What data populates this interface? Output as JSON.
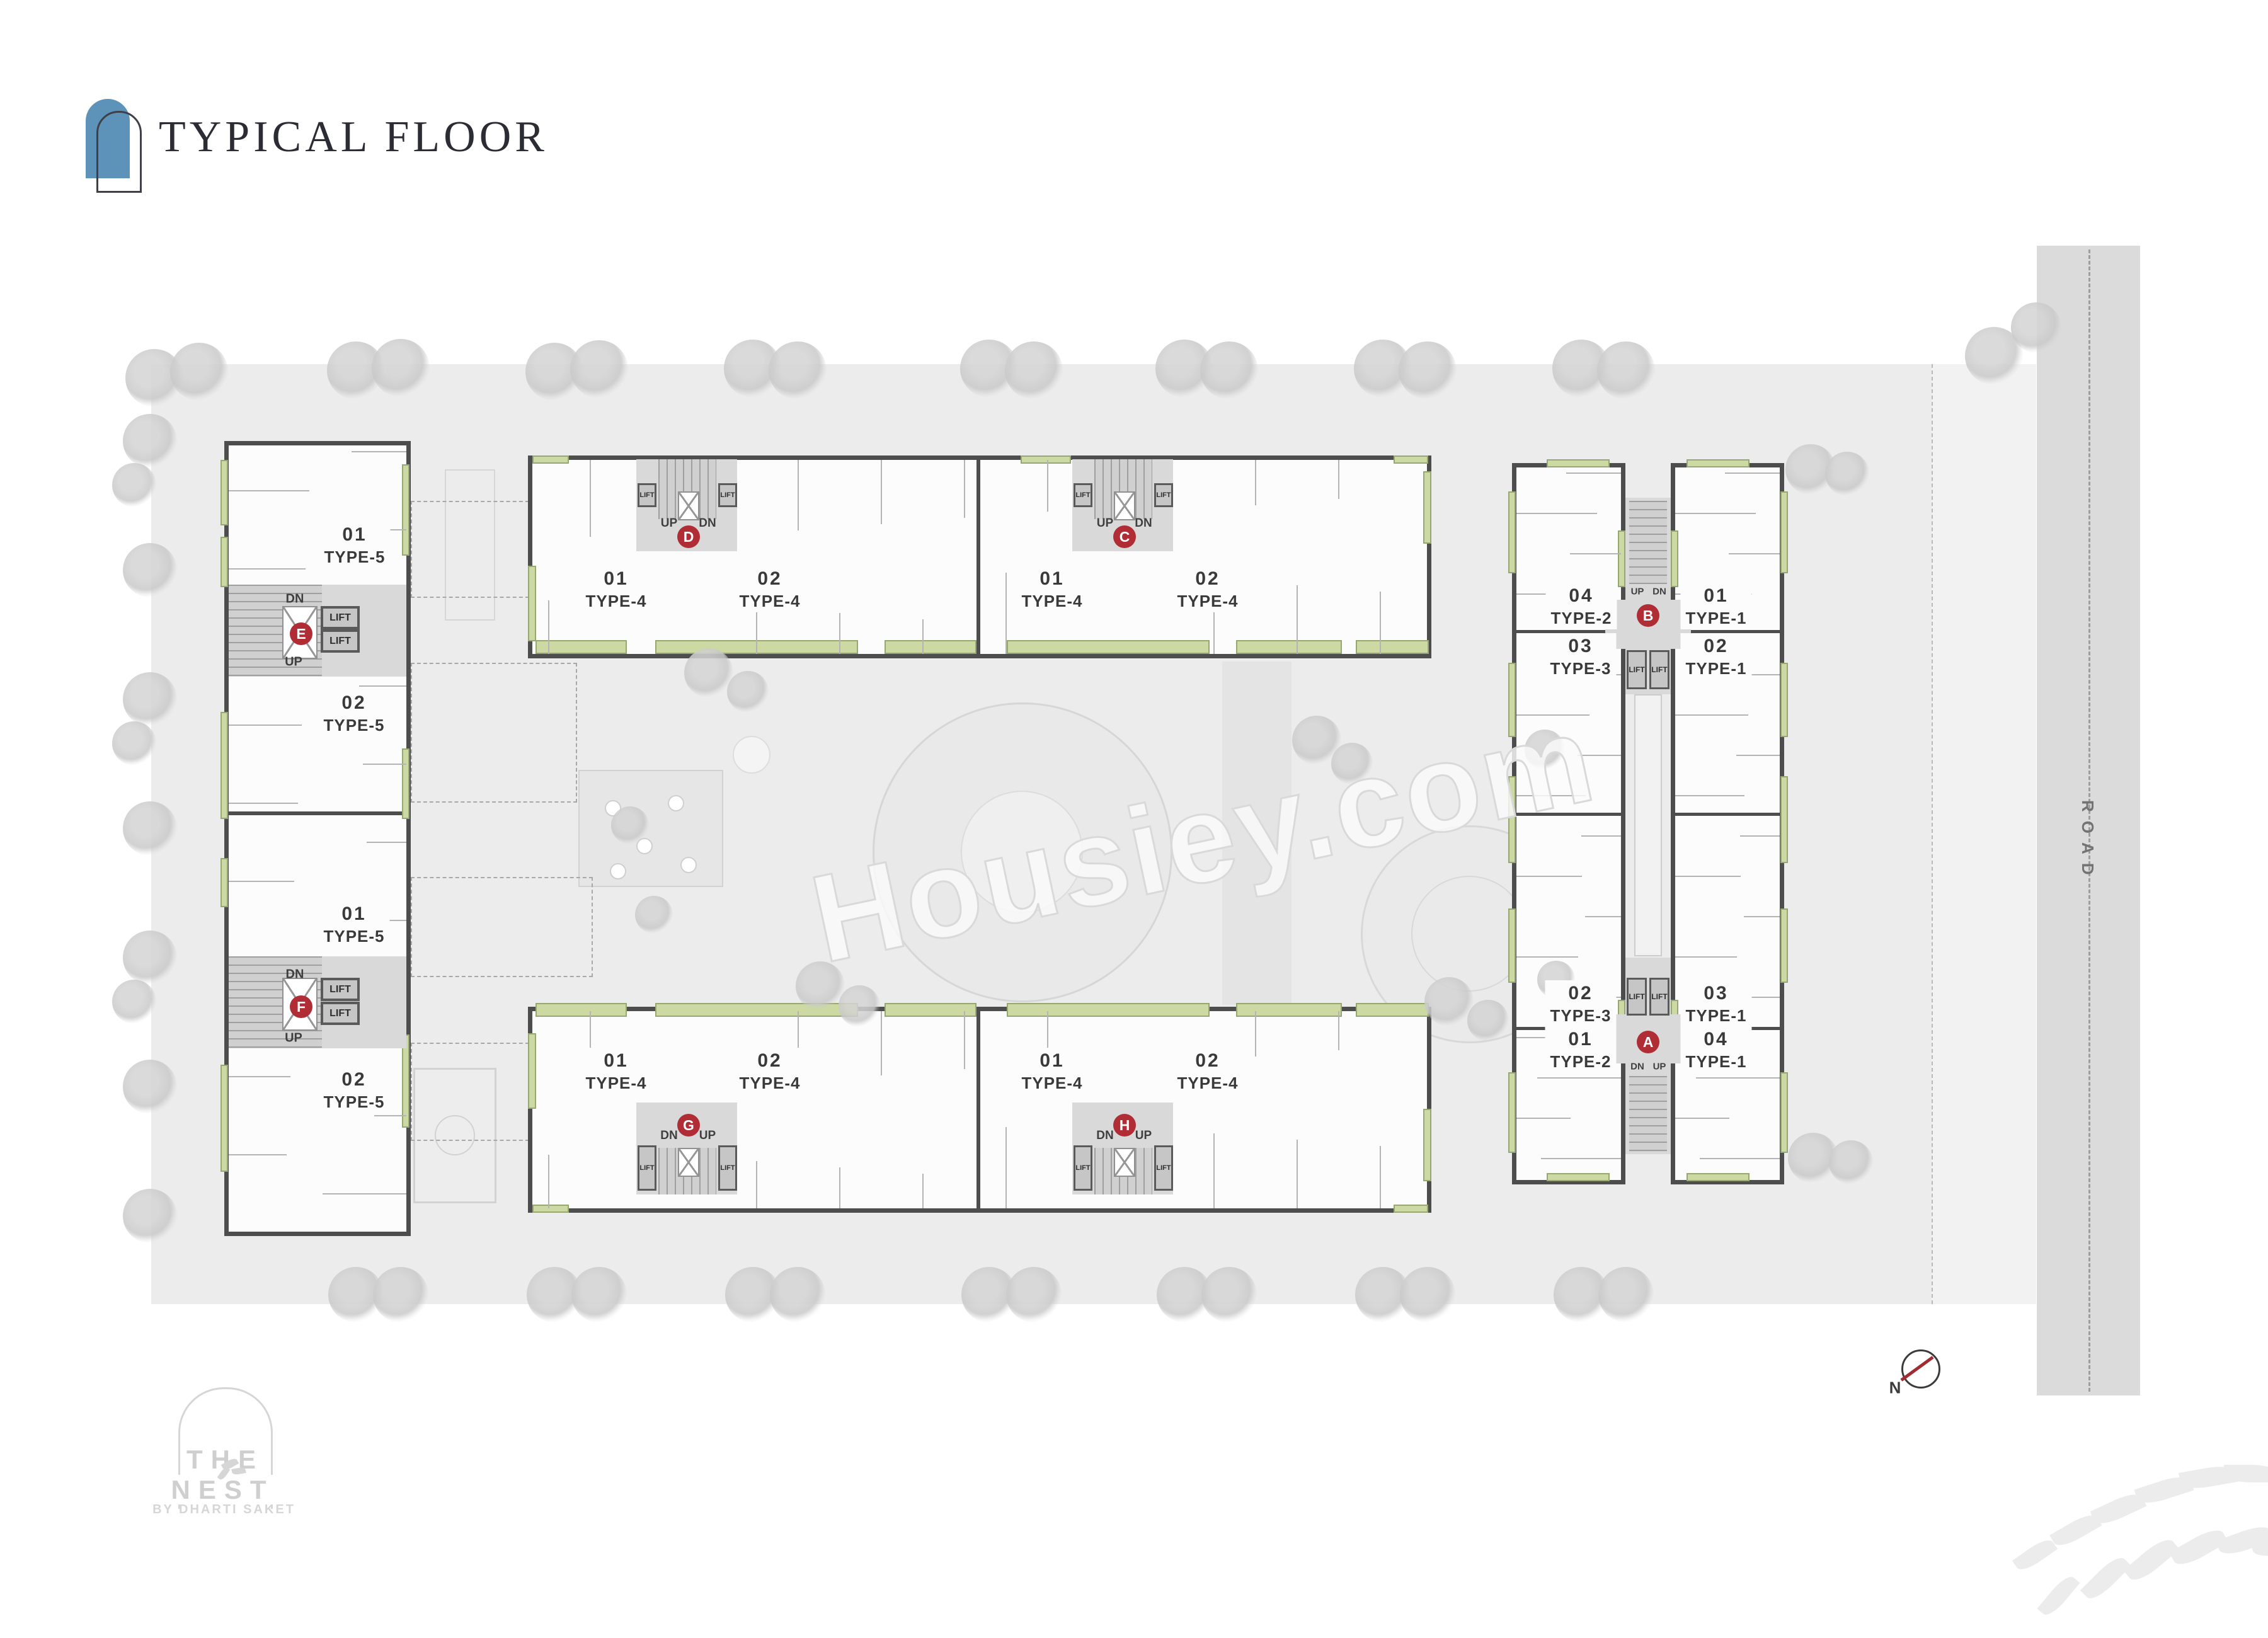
{
  "header": {
    "title": "TYPICAL FLOOR"
  },
  "watermark": "Housiey.com",
  "road": {
    "label": "ROAD"
  },
  "compass": {
    "north": "N"
  },
  "logo": {
    "name": "THE NEST",
    "by": "BY DHARTI SAKET"
  },
  "core_labels": {
    "lift": "LIFT",
    "up": "UP",
    "dn": "DN"
  },
  "blocks": {
    "west": {
      "units": [
        {
          "number": "01",
          "type": "TYPE-5"
        },
        {
          "number": "02",
          "type": "TYPE-5"
        },
        {
          "number": "01",
          "type": "TYPE-5"
        },
        {
          "number": "02",
          "type": "TYPE-5"
        }
      ],
      "cores": [
        {
          "letter": "E"
        },
        {
          "letter": "F"
        }
      ]
    },
    "north": {
      "units": [
        {
          "number": "01",
          "type": "TYPE-4"
        },
        {
          "number": "02",
          "type": "TYPE-4"
        },
        {
          "number": "01",
          "type": "TYPE-4"
        },
        {
          "number": "02",
          "type": "TYPE-4"
        }
      ],
      "cores": [
        {
          "letter": "D"
        },
        {
          "letter": "C"
        }
      ]
    },
    "south": {
      "units": [
        {
          "number": "01",
          "type": "TYPE-4"
        },
        {
          "number": "02",
          "type": "TYPE-4"
        },
        {
          "number": "01",
          "type": "TYPE-4"
        },
        {
          "number": "02",
          "type": "TYPE-4"
        }
      ],
      "cores": [
        {
          "letter": "G"
        },
        {
          "letter": "H"
        }
      ]
    },
    "east": {
      "units_top": [
        {
          "number": "04",
          "type": "TYPE-2"
        },
        {
          "number": "03",
          "type": "TYPE-3"
        },
        {
          "number": "01",
          "type": "TYPE-1"
        },
        {
          "number": "02",
          "type": "TYPE-1"
        }
      ],
      "units_bottom": [
        {
          "number": "02",
          "type": "TYPE-3"
        },
        {
          "number": "01",
          "type": "TYPE-2"
        },
        {
          "number": "03",
          "type": "TYPE-1"
        },
        {
          "number": "04",
          "type": "TYPE-1"
        }
      ],
      "cores": [
        {
          "letter": "B"
        },
        {
          "letter": "A"
        }
      ]
    }
  },
  "colors": {
    "accent_blue": "#5d93b8",
    "badge_red": "#b02d35",
    "balcony_green": "#ccd9a2"
  }
}
